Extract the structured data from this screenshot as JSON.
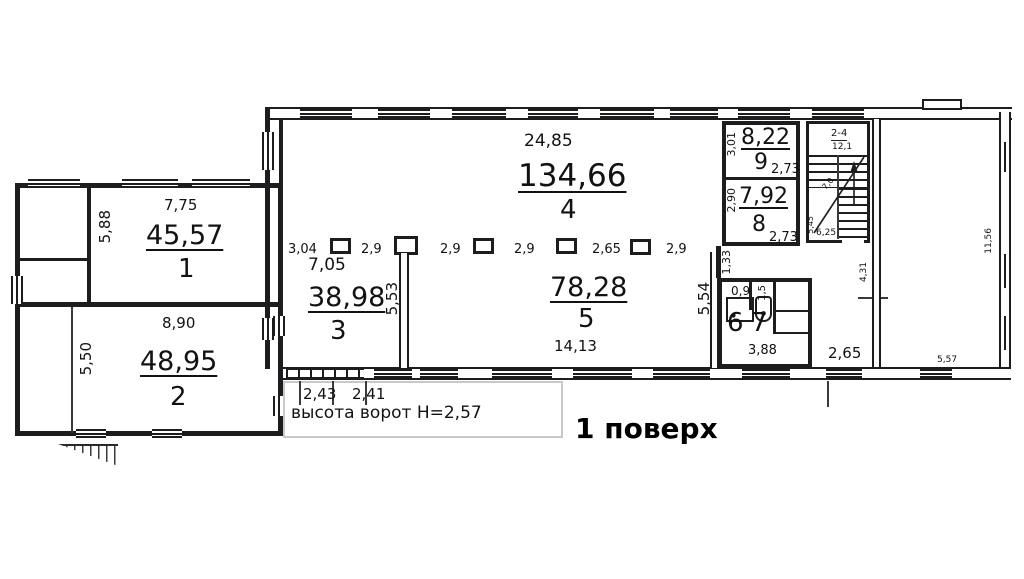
{
  "title": "1 поверх",
  "notes": {
    "gate_height": "высота ворот Н=2,57",
    "gate_w1": "2,43",
    "gate_w2": "2,41"
  },
  "rooms": {
    "r1": {
      "area": "45,57",
      "num": "1",
      "w": "7,75",
      "h": "5,88"
    },
    "r2": {
      "area": "48,95",
      "num": "2",
      "w": "8,90",
      "h": "5,50"
    },
    "r3": {
      "area": "38,98",
      "num": "3",
      "w": "7,05"
    },
    "r4": {
      "area": "134,66",
      "num": "4",
      "w": "24,85"
    },
    "r5": {
      "area": "78,28",
      "num": "5",
      "w": "14,13",
      "h": "5,54"
    },
    "r6": {
      "num": "6",
      "area": "0,9"
    },
    "r7": {
      "num": "7",
      "area": "1,5"
    },
    "r8": {
      "area": "7,92",
      "num": "8",
      "h": "2,90",
      "w": "2,73"
    },
    "r9": {
      "area": "8,22",
      "num": "9",
      "h": "3,01",
      "w": "2,73"
    },
    "wc_block": {
      "w": "3,88",
      "entry": "1,33"
    },
    "corridor": {
      "w": "2,65",
      "h": "4,31"
    },
    "right_room": {
      "w": "5,57",
      "h": "11,56"
    }
  },
  "stair": {
    "label": "2-4",
    "area": "12,1",
    "h": "5,45",
    "w": "6,25",
    "run": "7,0"
  },
  "columns": {
    "dims": [
      "3,04",
      "2,9",
      "2,9",
      "2,9",
      "2,65",
      "2,9"
    ],
    "partition": "5,53"
  }
}
